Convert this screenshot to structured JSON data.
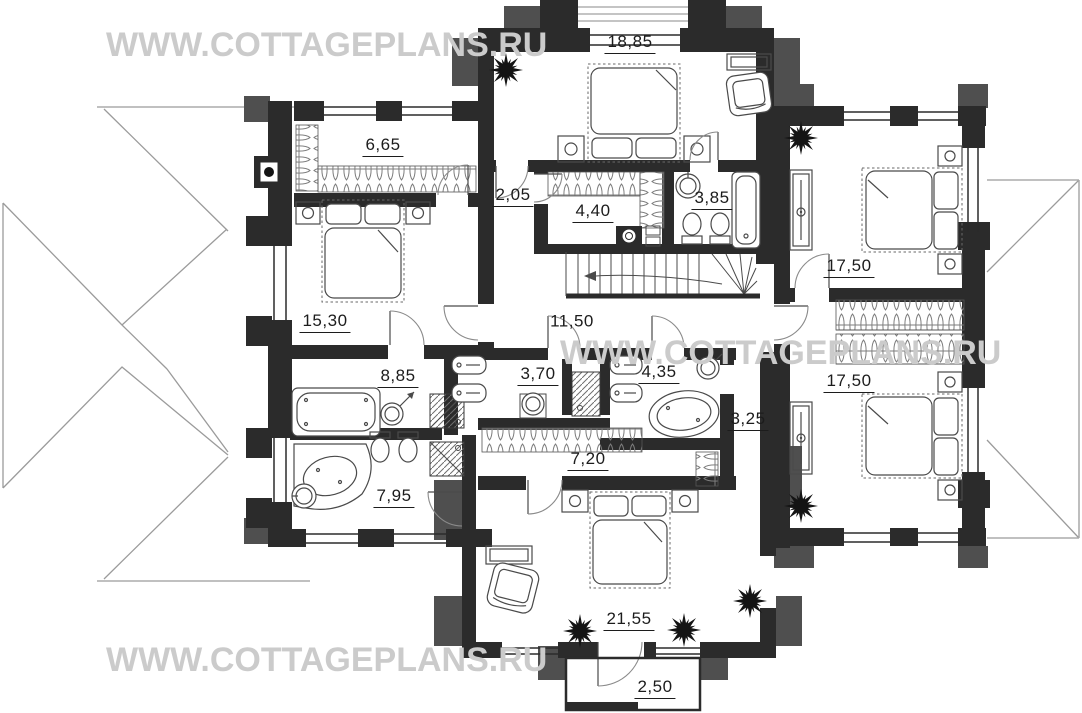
{
  "watermark": {
    "text": "WWW.COTTAGEPLANS.RU",
    "color": "#cbcbcb"
  },
  "plan": {
    "type": "floor-plan",
    "colors": {
      "wall": "#2b2b2b",
      "parapet_gray": "#4f4f4f",
      "roof_line": "#9b9b9b",
      "furniture_line": "#4a4a4a",
      "label_text": "#1c1c1c",
      "watermark": "#cbcbcb"
    },
    "rooms": [
      {
        "id": "room-18-85",
        "area": "18,85",
        "x": 630,
        "y": 43,
        "underline": true
      },
      {
        "id": "room-6-65",
        "area": "6,65",
        "x": 383,
        "y": 146,
        "underline": true
      },
      {
        "id": "room-2-05",
        "area": "2,05",
        "x": 513,
        "y": 196,
        "underline": true
      },
      {
        "id": "room-4-40",
        "area": "4,40",
        "x": 593,
        "y": 212,
        "underline": true
      },
      {
        "id": "room-3-85",
        "area": "3,85",
        "x": 712,
        "y": 199,
        "underline": true
      },
      {
        "id": "room-17-50-top",
        "area": "17,50",
        "x": 849,
        "y": 267,
        "underline": true
      },
      {
        "id": "room-15-30",
        "area": "15,30",
        "x": 325,
        "y": 322,
        "underline": true
      },
      {
        "id": "room-11-50",
        "area": "11,50",
        "x": 572,
        "y": 322,
        "underline": false
      },
      {
        "id": "room-8-85",
        "area": "8,85",
        "x": 398,
        "y": 377,
        "underline": true
      },
      {
        "id": "room-3-70",
        "area": "3,70",
        "x": 538,
        "y": 375,
        "underline": true
      },
      {
        "id": "room-4-35",
        "area": "4,35",
        "x": 659,
        "y": 373,
        "underline": true
      },
      {
        "id": "room-17-50-bottom",
        "area": "17,50",
        "x": 849,
        "y": 382,
        "underline": true
      },
      {
        "id": "room-3-25",
        "area": "3,25",
        "x": 748,
        "y": 420,
        "underline": true
      },
      {
        "id": "room-7-20",
        "area": "7,20",
        "x": 588,
        "y": 460,
        "underline": true
      },
      {
        "id": "room-7-95",
        "area": "7,95",
        "x": 394,
        "y": 497,
        "underline": true
      },
      {
        "id": "room-21-55",
        "area": "21,55",
        "x": 629,
        "y": 620,
        "underline": true
      },
      {
        "id": "room-2-50",
        "area": "2,50",
        "x": 655,
        "y": 688,
        "underline": true
      }
    ]
  }
}
